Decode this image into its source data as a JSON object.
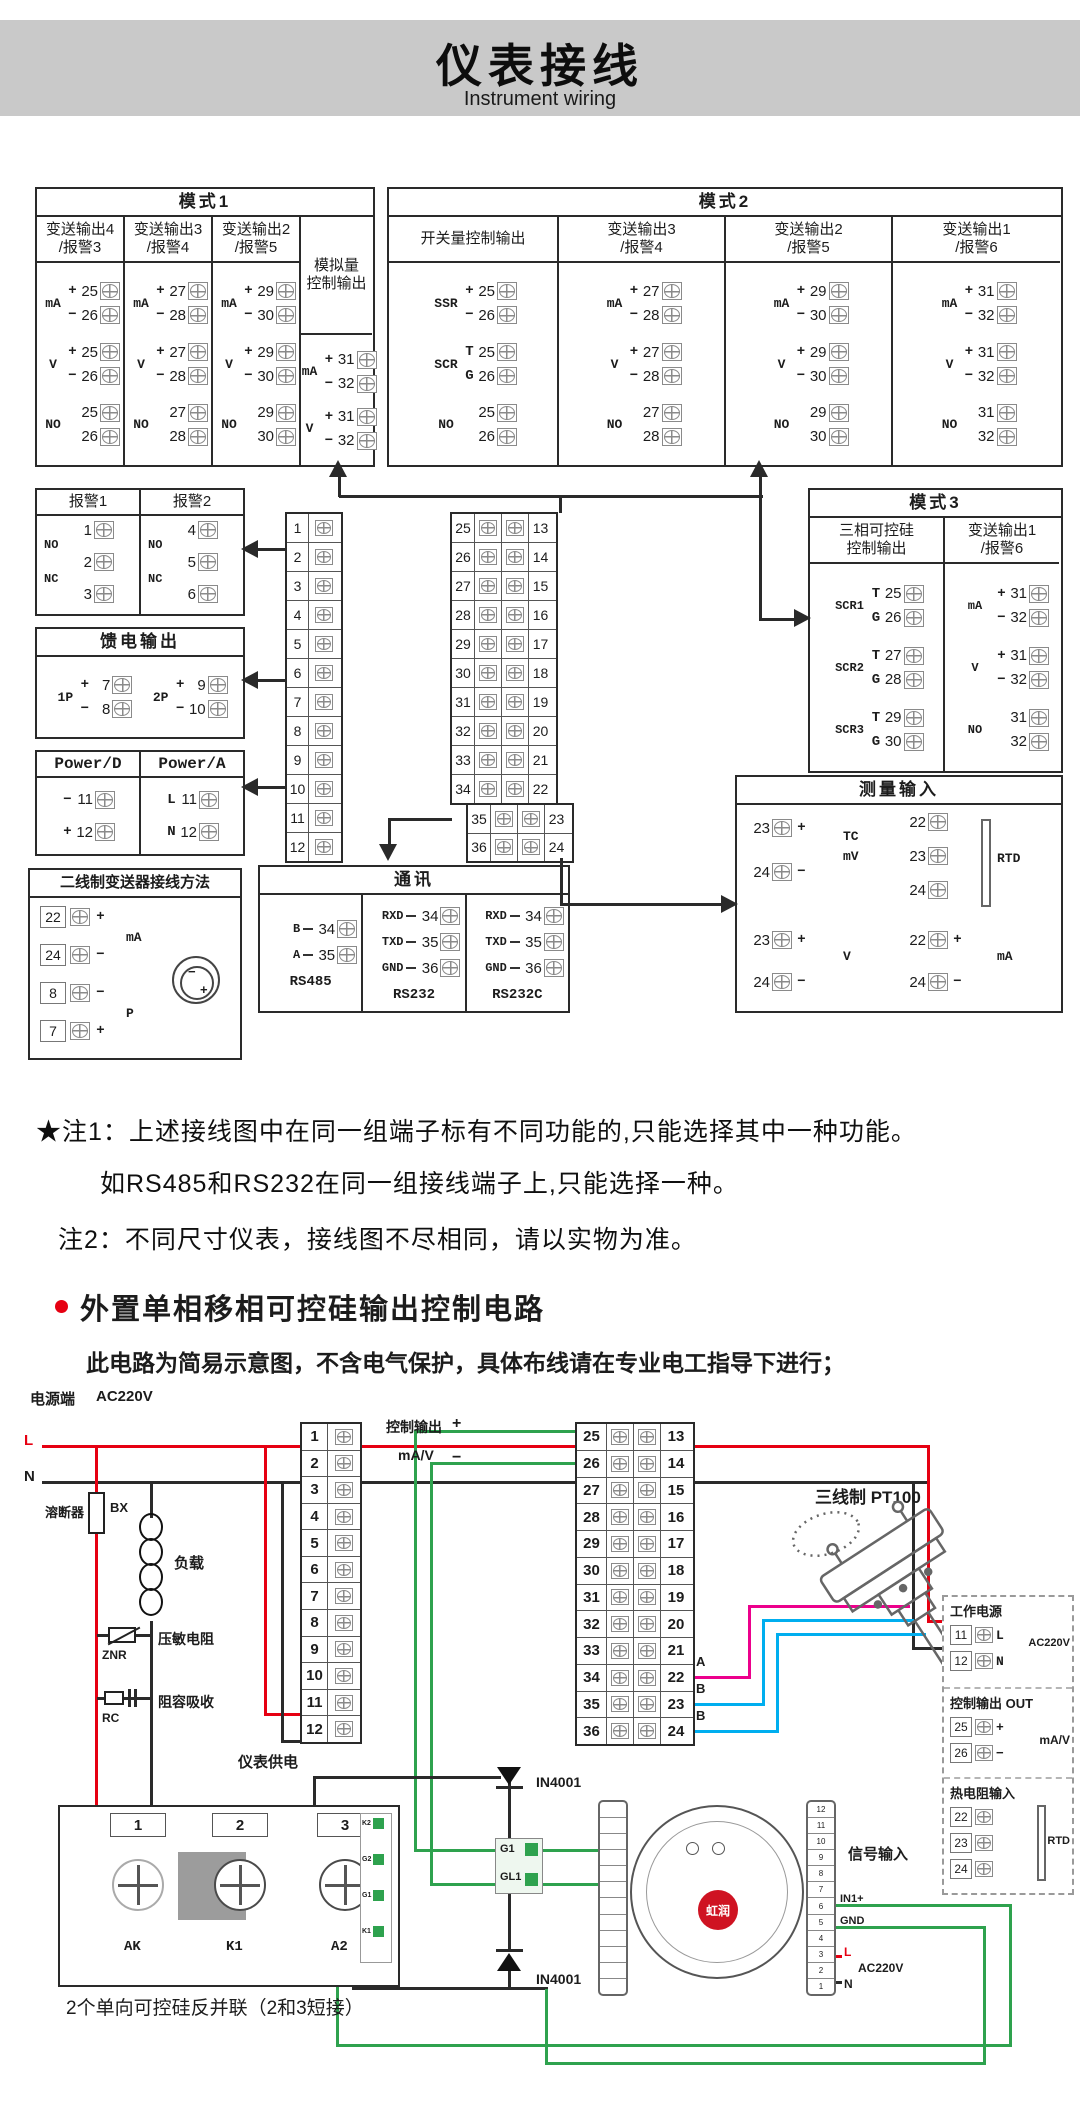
{
  "header": {
    "title": "仪表接线",
    "subtitle": "Instrument wiring"
  },
  "colors": {
    "accent_red": "#e60012",
    "wire_green": "#2ea24e",
    "wire_cyan": "#00aeef",
    "wire_magenta": "#ec008c",
    "header_gray": "#c9c9c9"
  },
  "mode1": {
    "title": "模式1",
    "cols": [
      {
        "header": [
          "变送输出4",
          "/报警3"
        ],
        "groups": [
          {
            "l": "mA",
            "r": [
              [
                "+",
                "25"
              ],
              [
                "−",
                "26"
              ]
            ]
          },
          {
            "l": "V",
            "r": [
              [
                "+",
                "25"
              ],
              [
                "−",
                "26"
              ]
            ]
          },
          {
            "l": "NO",
            "r": [
              [
                "",
                "25"
              ],
              [
                "",
                "26"
              ]
            ]
          }
        ]
      },
      {
        "header": [
          "变送输出3",
          "/报警4"
        ],
        "groups": [
          {
            "l": "mA",
            "r": [
              [
                "+",
                "27"
              ],
              [
                "−",
                "28"
              ]
            ]
          },
          {
            "l": "V",
            "r": [
              [
                "+",
                "27"
              ],
              [
                "−",
                "28"
              ]
            ]
          },
          {
            "l": "NO",
            "r": [
              [
                "",
                "27"
              ],
              [
                "",
                "28"
              ]
            ]
          }
        ]
      },
      {
        "header": [
          "变送输出2",
          "/报警5"
        ],
        "groups": [
          {
            "l": "mA",
            "r": [
              [
                "+",
                "29"
              ],
              [
                "−",
                "30"
              ]
            ]
          },
          {
            "l": "V",
            "r": [
              [
                "+",
                "29"
              ],
              [
                "−",
                "30"
              ]
            ]
          },
          {
            "l": "NO",
            "r": [
              [
                "",
                "29"
              ],
              [
                "",
                "30"
              ]
            ]
          }
        ]
      },
      {
        "header": [
          "模拟量",
          "控制输出"
        ],
        "tall": true,
        "groups": [
          {
            "l": "mA",
            "r": [
              [
                "+",
                "31"
              ],
              [
                "−",
                "32"
              ]
            ]
          },
          {
            "l": "V",
            "r": [
              [
                "+",
                "31"
              ],
              [
                "−",
                "32"
              ]
            ]
          }
        ]
      }
    ]
  },
  "mode2": {
    "title": "模式2",
    "cols": [
      {
        "header": [
          "开关量控制输出"
        ],
        "groups": [
          {
            "l": "SSR",
            "r": [
              [
                "+",
                "25"
              ],
              [
                "−",
                "26"
              ]
            ]
          },
          {
            "l": "SCR",
            "r": [
              [
                "T",
                "25"
              ],
              [
                "G",
                "26"
              ]
            ]
          },
          {
            "l": "NO",
            "r": [
              [
                "",
                "25"
              ],
              [
                "",
                "26"
              ]
            ]
          }
        ]
      },
      {
        "header": [
          "变送输出3",
          "/报警4"
        ],
        "groups": [
          {
            "l": "mA",
            "r": [
              [
                "+",
                "27"
              ],
              [
                "−",
                "28"
              ]
            ]
          },
          {
            "l": "V",
            "r": [
              [
                "+",
                "27"
              ],
              [
                "−",
                "28"
              ]
            ]
          },
          {
            "l": "NO",
            "r": [
              [
                "",
                "27"
              ],
              [
                "",
                "28"
              ]
            ]
          }
        ]
      },
      {
        "header": [
          "变送输出2",
          "/报警5"
        ],
        "groups": [
          {
            "l": "mA",
            "r": [
              [
                "+",
                "29"
              ],
              [
                "−",
                "30"
              ]
            ]
          },
          {
            "l": "V",
            "r": [
              [
                "+",
                "29"
              ],
              [
                "−",
                "30"
              ]
            ]
          },
          {
            "l": "NO",
            "r": [
              [
                "",
                "29"
              ],
              [
                "",
                "30"
              ]
            ]
          }
        ]
      },
      {
        "header": [
          "变送输出1",
          "/报警6"
        ],
        "groups": [
          {
            "l": "mA",
            "r": [
              [
                "+",
                "31"
              ],
              [
                "−",
                "32"
              ]
            ]
          },
          {
            "l": "V",
            "r": [
              [
                "+",
                "31"
              ],
              [
                "−",
                "32"
              ]
            ]
          },
          {
            "l": "NO",
            "r": [
              [
                "",
                "31"
              ],
              [
                "",
                "32"
              ]
            ]
          }
        ]
      }
    ]
  },
  "mode3": {
    "title": "模式3",
    "cols": [
      {
        "header": [
          "三相可控硅",
          "控制输出"
        ],
        "groups": [
          {
            "l": "SCR1",
            "r": [
              [
                "T",
                "25"
              ],
              [
                "G",
                "26"
              ]
            ]
          },
          {
            "l": "SCR2",
            "r": [
              [
                "T",
                "27"
              ],
              [
                "G",
                "28"
              ]
            ]
          },
          {
            "l": "SCR3",
            "r": [
              [
                "T",
                "29"
              ],
              [
                "G",
                "30"
              ]
            ]
          }
        ]
      },
      {
        "header": [
          "变送输出1",
          "/报警6"
        ],
        "groups": [
          {
            "l": "mA",
            "r": [
              [
                "+",
                "31"
              ],
              [
                "−",
                "32"
              ]
            ]
          },
          {
            "l": "V",
            "r": [
              [
                "+",
                "31"
              ],
              [
                "−",
                "32"
              ]
            ]
          },
          {
            "l": "NO",
            "r": [
              [
                "",
                "31"
              ],
              [
                "",
                "32"
              ]
            ]
          }
        ]
      }
    ]
  },
  "alarm": {
    "cols": [
      {
        "title": "报警1",
        "nums": [
          "1",
          "2",
          "3"
        ]
      },
      {
        "title": "报警2",
        "nums": [
          "4",
          "5",
          "6"
        ]
      }
    ],
    "no": "NO",
    "nc": "NC"
  },
  "feed": {
    "title": "馈电输出",
    "groups": [
      {
        "l": "1P",
        "r": [
          [
            "+",
            "7"
          ],
          [
            "−",
            "8"
          ]
        ]
      },
      {
        "l": "2P",
        "r": [
          [
            "+",
            "9"
          ],
          [
            "−",
            "10"
          ]
        ]
      }
    ]
  },
  "power": {
    "cols": [
      {
        "title": "Power/D",
        "rows": [
          [
            "−",
            "11"
          ],
          [
            "+",
            "12"
          ]
        ]
      },
      {
        "title": "Power/A",
        "rows": [
          [
            "L",
            "11"
          ],
          [
            "N",
            "12"
          ]
        ]
      }
    ]
  },
  "twowire": {
    "title": "二线制变送器接线方法",
    "rows": [
      {
        "n": "22",
        "s": "+"
      },
      {
        "n": "24",
        "s": "−"
      },
      {
        "n": "8",
        "s": "−"
      },
      {
        "n": "7",
        "s": "+"
      }
    ],
    "lbl1": "mA",
    "lbl2": "P",
    "tx_minus": "−",
    "tx_plus": "+"
  },
  "strips": {
    "a": [
      "1",
      "2",
      "3",
      "4",
      "5",
      "6",
      "7",
      "8",
      "9",
      "10",
      "11",
      "12"
    ],
    "b_main": [
      [
        "25",
        "13"
      ],
      [
        "26",
        "14"
      ],
      [
        "27",
        "15"
      ],
      [
        "28",
        "16"
      ],
      [
        "29",
        "17"
      ],
      [
        "30",
        "18"
      ],
      [
        "31",
        "19"
      ],
      [
        "32",
        "20"
      ],
      [
        "33",
        "21"
      ],
      [
        "34",
        "22"
      ]
    ],
    "b_off": [
      [
        "35",
        "23"
      ],
      [
        "36",
        "24"
      ]
    ],
    "b_full": [
      [
        "25",
        "13"
      ],
      [
        "26",
        "14"
      ],
      [
        "27",
        "15"
      ],
      [
        "28",
        "16"
      ],
      [
        "29",
        "17"
      ],
      [
        "30",
        "18"
      ],
      [
        "31",
        "19"
      ],
      [
        "32",
        "20"
      ],
      [
        "33",
        "21"
      ],
      [
        "34",
        "22"
      ],
      [
        "35",
        "23"
      ],
      [
        "36",
        "24"
      ]
    ]
  },
  "comm": {
    "title": "通讯",
    "cols": [
      {
        "name": "RS485",
        "rows": [
          [
            "B",
            "34"
          ],
          [
            "A",
            "35"
          ]
        ]
      },
      {
        "name": "RS232",
        "rows": [
          [
            "RXD",
            "34"
          ],
          [
            "TXD",
            "35"
          ],
          [
            "GND",
            "36"
          ]
        ]
      },
      {
        "name": "RS232C",
        "rows": [
          [
            "RXD",
            "34"
          ],
          [
            "TXD",
            "35"
          ],
          [
            "GND",
            "36"
          ]
        ]
      }
    ]
  },
  "measure": {
    "title": "测量输入",
    "tc": {
      "labels": [
        "TC",
        "mV"
      ],
      "rows": [
        [
          "23",
          "+"
        ],
        [
          "24",
          "−"
        ]
      ]
    },
    "rtd": {
      "label": "RTD",
      "nums": [
        "22",
        "23",
        "24"
      ]
    },
    "v": {
      "label": "V",
      "rows": [
        [
          "23",
          "+"
        ],
        [
          "24",
          "−"
        ]
      ]
    },
    "ma": {
      "label": "mA",
      "rows": [
        [
          "22",
          "+"
        ],
        [
          "24",
          "−"
        ]
      ]
    }
  },
  "notes": {
    "n1a": "★注1：上述接线图中在同一组端子标有不同功能的,只能选择其中一种功能。",
    "n1b": "如RS485和RS232在同一组接线端子上,只能选择一种。",
    "n2": "注2：不同尺寸仪表，接线图不尽相同，请以实物为准。"
  },
  "section2": {
    "heading": "外置单相移相可控硅输出控制电路",
    "subnote": "此电路为简易示意图，不含电气保护，具体布线请在专业电工指导下进行；"
  },
  "circuit": {
    "power_label": "电源端",
    "voltage": "AC220V",
    "l": "L",
    "n": "N",
    "fuse": "溶断器",
    "fuse_code": "BX",
    "load": "负载",
    "varistor": "压敏电阻",
    "varistor_code": "ZNR",
    "rc": "阻容吸收",
    "rc_code": "RC",
    "supply": "仪表供电",
    "ctrl": "控制输出",
    "plus": "+",
    "minus": "−",
    "mav": "mA/V",
    "pt100": "三线制 PT100",
    "a": "A",
    "b1": "B",
    "b2": "B",
    "signal": "信号输入",
    "diode1": "IN4001",
    "diode2": "IN4001",
    "g1": "G1",
    "gl1": "GL1",
    "scr_module": {
      "nums": [
        "1",
        "2",
        "3"
      ],
      "labels": [
        "AK",
        "K1",
        "A2"
      ],
      "side": [
        "K2",
        "G2",
        "G1",
        "K1"
      ],
      "caption": "2个单向可控硅反并联（2和3短接）"
    },
    "device": {
      "brand": "虹润",
      "right_nums": [
        "12",
        "11",
        "10",
        "9",
        "8",
        "7",
        "6",
        "5",
        "4",
        "3",
        "2",
        "1"
      ],
      "in1": "IN1+",
      "gnd": "GND",
      "l": "L",
      "n": "N",
      "ac": "AC220V"
    },
    "dashed": {
      "s1_title": "工作电源",
      "s1_rows": [
        [
          "11",
          "L"
        ],
        [
          "12",
          "N"
        ]
      ],
      "s1_v": "AC220V",
      "s2_title": "控制输出 OUT",
      "s2_rows": [
        [
          "25",
          "+"
        ],
        [
          "26",
          "−"
        ]
      ],
      "s2_label": "mA/V",
      "s3_title": "热电阻输入",
      "s3_nums": [
        "22",
        "23",
        "24"
      ],
      "s3_label": "RTD"
    }
  }
}
